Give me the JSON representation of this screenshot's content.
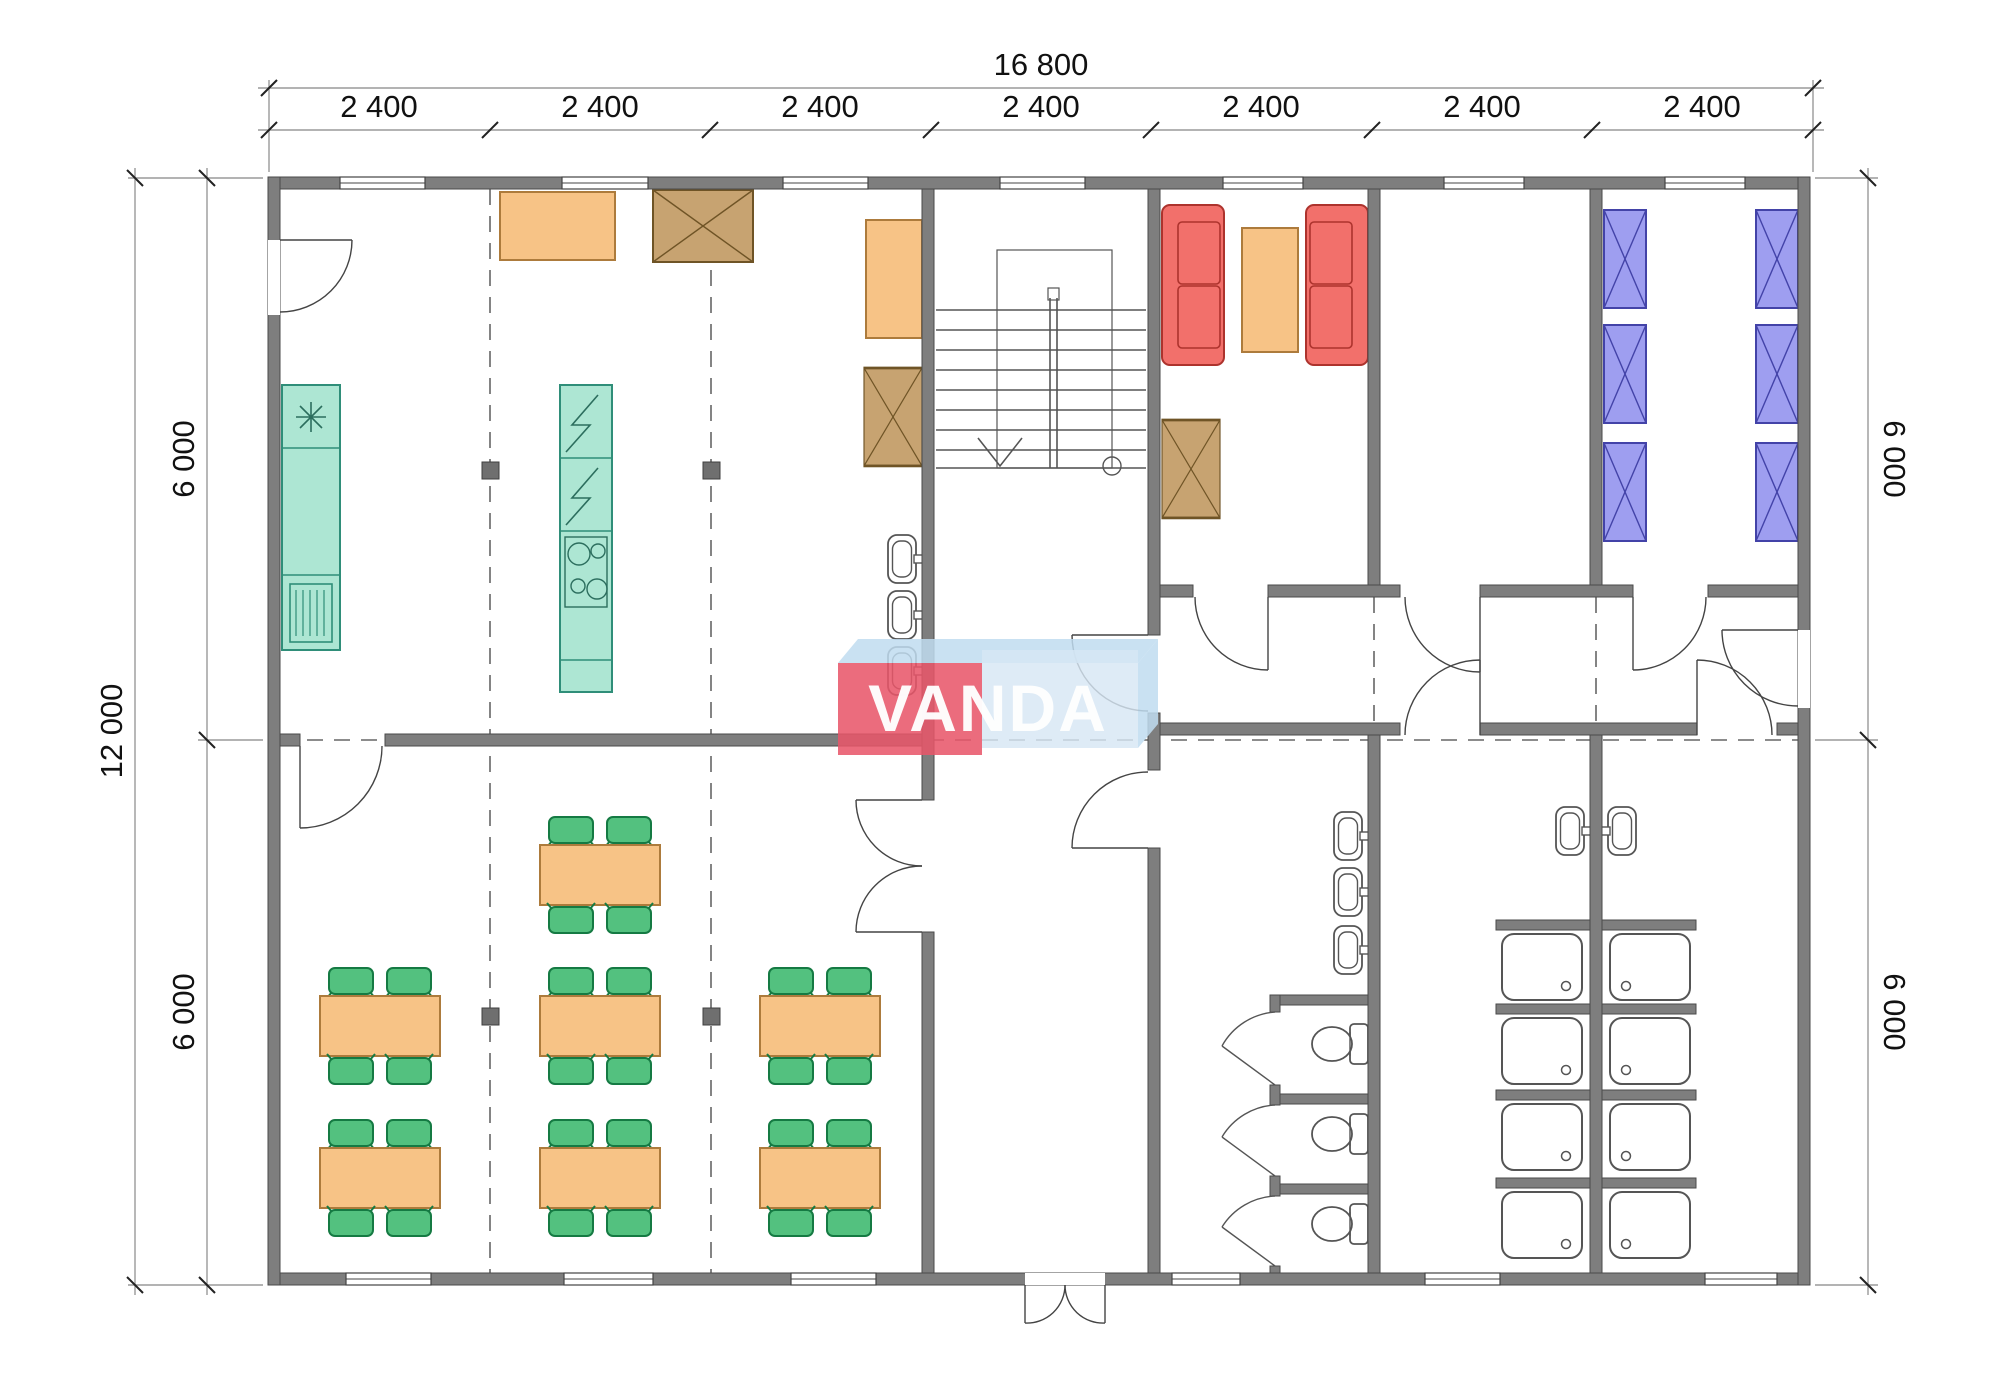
{
  "watermark": {
    "text": "VANDA",
    "red": "#e8566a",
    "light_blue": "#bfdcf0",
    "pale_blue": "#d7e6f4"
  },
  "dimensions": {
    "overall_width": "16 800",
    "bays": [
      "2 400",
      "2 400",
      "2 400",
      "2 400",
      "2 400",
      "2 400",
      "2 400"
    ],
    "overall_height": "12 000",
    "left_segments": [
      "6 000",
      "6 000"
    ],
    "right_segments": [
      "6 000",
      "6 000"
    ]
  },
  "inventory": {
    "dining_tables": 7,
    "chairs_per_table": 4,
    "beds": 6,
    "sofas": 2,
    "shower_cubicles": 8,
    "toilets": 3,
    "washbasins": 8,
    "wardrobes": 4,
    "stair_flights": 1
  },
  "colors": {
    "wall": "#7e7e7e",
    "furniture_orange": "#f7c386",
    "appliance_teal": "#ade6d3",
    "wardrobe_brown": "#c7a371",
    "sofa_red": "#f2706b",
    "bed_blue": "#9e9ef0",
    "chair_green": "#53c17f",
    "column_gray": "#6f6f6f"
  }
}
